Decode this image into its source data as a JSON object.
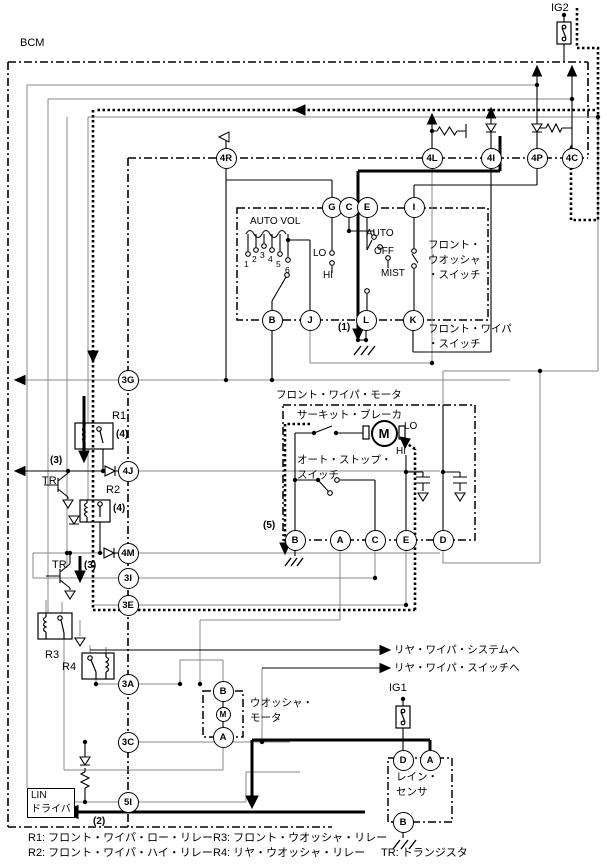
{
  "bcm_label": "BCM",
  "ig2_label": "IG2",
  "ig1_label": "IG1",
  "combo_switch": {
    "auto_vol": "AUTO VOL",
    "pos1": "1",
    "pos2": "2",
    "pos3": "3",
    "pos4": "4",
    "pos5": "5",
    "pos6": "6",
    "lo": "LO",
    "hi": "HI",
    "auto": "AUTO",
    "off": "OFF",
    "mist": "MIST",
    "washer_switch": "フロント・\nウオッシャ\n・スイッチ",
    "wiper_switch": "フロント・ワイパ\n・スイッチ"
  },
  "wiper_motor": {
    "title": "フロント・ワイパ・モータ",
    "circuit_breaker": "サーキット・ブレーカ",
    "auto_stop_switch": "オート・ストップ・\nスイッチ",
    "lo": "LO",
    "hi": "HI",
    "motor": "M"
  },
  "washer_motor": {
    "label": "ウオッシャ・\nモータ",
    "motor": "M"
  },
  "rain_sensor": {
    "label": "レイン・\nセンサ"
  },
  "lin_driver": {
    "label": "LIN\nドライバ"
  },
  "rear_links": {
    "to_system": "リヤ・ワイパ・システムへ",
    "to_switch": "リヤ・ワイパ・スイッチへ"
  },
  "refs": {
    "n1": "(1)",
    "n2": "(2)",
    "n3a": "(3)",
    "n3b": "(3)",
    "n4a": "(4)",
    "n4b": "(4)",
    "n5": "(5)",
    "r1": "R1",
    "r2": "R2",
    "r3": "R3",
    "r4": "R4",
    "tr1": "TR",
    "tr2": "TR"
  },
  "connectors": {
    "b4R": "4R",
    "b4L": "4L",
    "b4I": "4I",
    "b4P": "4P",
    "b4C": "4C",
    "sG": "G",
    "sC": "C",
    "sE": "E",
    "sI": "I",
    "sB": "B",
    "sJ": "J",
    "sL": "L",
    "sK": "K",
    "b3G": "3G",
    "b4J": "4J",
    "b4M": "4M",
    "b3I": "3I",
    "b3E": "3E",
    "b3A": "3A",
    "b3C": "3C",
    "b5I": "5I",
    "mB": "B",
    "mA": "A",
    "mC": "C",
    "mE": "E",
    "mD": "D",
    "wB": "B",
    "wA": "A",
    "rD": "D",
    "rA": "A",
    "rB": "B"
  },
  "legend": {
    "r1": "R1: フロント・ワイパ・ロー・リレー",
    "r2": "R2: フロント・ワイパ・ハイ・リレー",
    "r3": "R3: フロント・ウオッシャ・リレー",
    "r4": "R4: リヤ・ウオッシャ・リレー",
    "tr": "TR: トランジスタ"
  }
}
